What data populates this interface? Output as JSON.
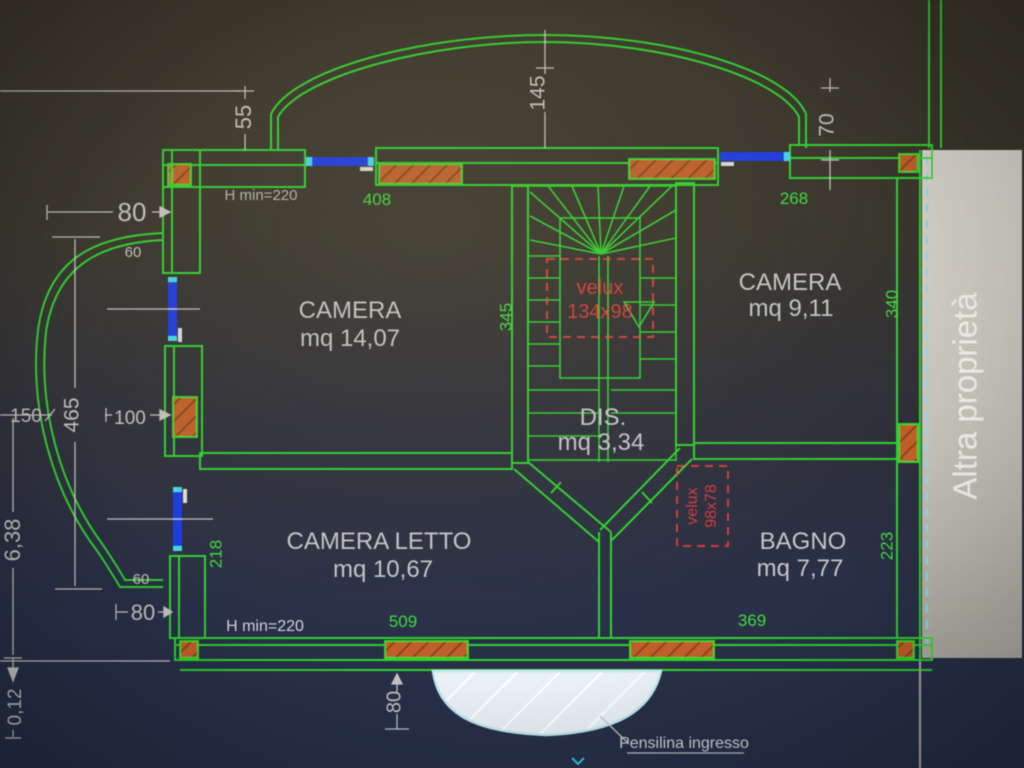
{
  "plan": {
    "rooms": [
      {
        "name": "CAMERA",
        "area": "mq 14,07"
      },
      {
        "name": "CAMERA",
        "area": "mq 9,11"
      },
      {
        "name": "DIS.",
        "area": "mq 3,34"
      },
      {
        "name": "CAMERA LETTO",
        "area": "mq 10,67"
      },
      {
        "name": "BAGNO",
        "area": "mq 7,77"
      }
    ],
    "skylights": [
      {
        "label": "velux",
        "size": "134x98"
      },
      {
        "label": "velux",
        "size": "98x78"
      }
    ],
    "notes": {
      "h_min_top": "H min=220",
      "h_min_bottom": "H min=220",
      "canopy": "Pensilina ingresso",
      "neighbor": "Altra proprietà"
    },
    "dims": {
      "green": {
        "top_left": "408",
        "top_right": "268",
        "stair_side": "345",
        "camera_right_side": "340",
        "letto_side": "218",
        "bagno_side": "223",
        "bottom_left": "509",
        "bottom_right": "369"
      },
      "white": {
        "arc_left": "55",
        "arc_center": "145",
        "arc_right": "70",
        "upper_offset": "80",
        "upper_small": "60",
        "balcony_width": "150",
        "balcony_height": "465",
        "window_offset": "100",
        "total_height": "6,38",
        "lower_small": "60",
        "lower_offset": "80",
        "step": "0,12",
        "canopy_depth": "80"
      }
    },
    "colors": {
      "line_green": "#2fd32f",
      "dim_white": "#c4c3c0",
      "hatch_orange": "#bf5f2a",
      "window_blue": "#1d3be0",
      "window_cyan": "#45d5e5",
      "velux_red": "#d23c3c",
      "band_gray": "#cbc8bf",
      "bg_top": "#3a352a",
      "bg_bottom": "#263048"
    }
  }
}
